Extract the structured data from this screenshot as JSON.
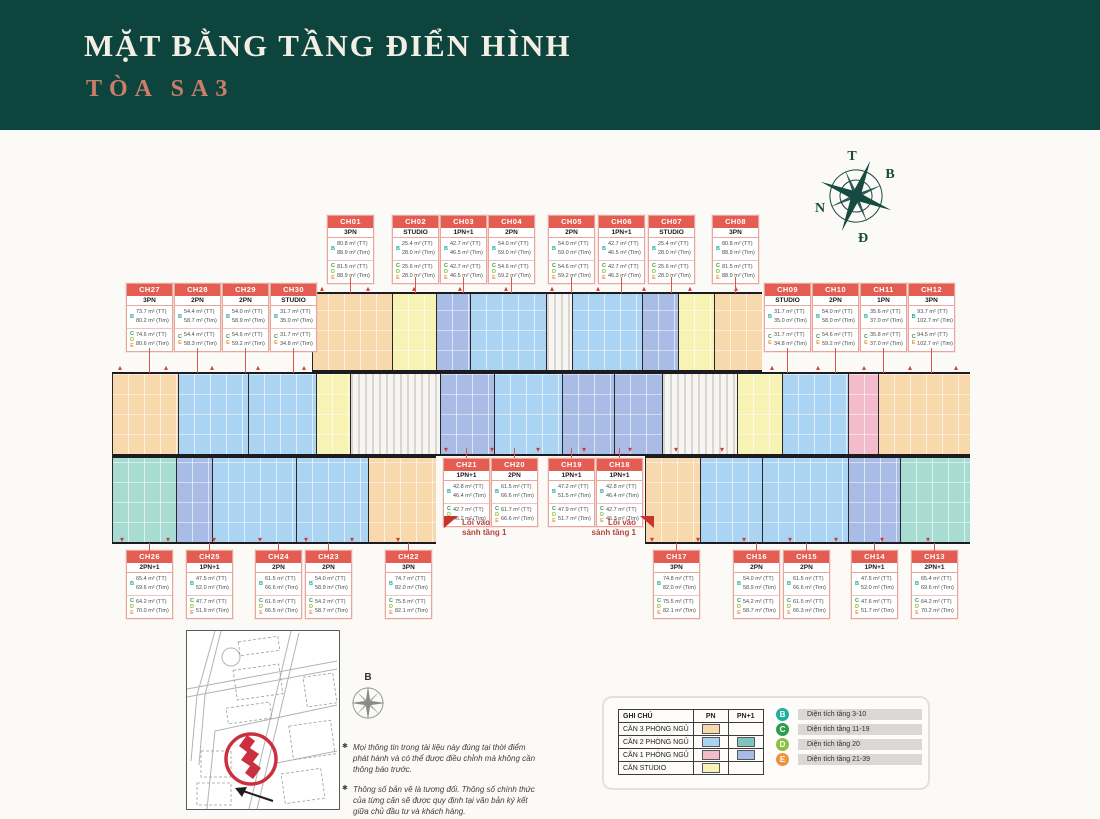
{
  "header": {
    "title": "MẶT BẰNG TẦNG ĐIỂN HÌNH",
    "subtitle": "TÒA SA3",
    "bg_color": "#0d453e",
    "subtitle_color": "#cb7e69"
  },
  "compass": {
    "t": "T",
    "b": "B",
    "n": "N",
    "d": "Đ"
  },
  "labels": {
    "tt": "(TT)",
    "tim": "(Tim)",
    "entrance_line1": "Lối vào",
    "entrance_line2": "sảnh tầng 1"
  },
  "type_colors": {
    "3PN": "#f7d9ad",
    "2PN": "#aad4f2",
    "2PN+1": "#a8dcd3",
    "1PN": "#f3bccd",
    "1PN+1": "#a9bce5",
    "STUDIO": "#f7f3b5",
    "core": "#f6f5f1"
  },
  "units": [
    {
      "id": "CH01",
      "type": "3PN",
      "row": "top",
      "pos": [
        327,
        215
      ],
      "rows": [
        {
          "f": "B",
          "tt": "80.8 m²",
          "tim": "88.9 m²"
        },
        {
          "f": "CDE",
          "tt": "81.5 m²",
          "tim": "88.9 m²"
        }
      ]
    },
    {
      "id": "CH02",
      "type": "STUDIO",
      "row": "top",
      "pos": [
        392,
        215
      ],
      "rows": [
        {
          "f": "B",
          "tt": "25.4 m²",
          "tim": "28.0 m²"
        },
        {
          "f": "CDE",
          "tt": "25.6 m²",
          "tim": "28.0 m²"
        }
      ]
    },
    {
      "id": "CH03",
      "type": "1PN+1",
      "row": "top",
      "pos": [
        440,
        215
      ],
      "rows": [
        {
          "f": "B",
          "tt": "42.7 m²",
          "tim": "46.5 m²"
        },
        {
          "f": "CDE",
          "tt": "42.7 m²",
          "tim": "46.5 m²"
        }
      ]
    },
    {
      "id": "CH04",
      "type": "2PN",
      "row": "top",
      "pos": [
        488,
        215
      ],
      "rows": [
        {
          "f": "B",
          "tt": "54.0 m²",
          "tim": "59.0 m²"
        },
        {
          "f": "CDE",
          "tt": "54.6 m²",
          "tim": "59.2 m²"
        }
      ]
    },
    {
      "id": "CH05",
      "type": "2PN",
      "row": "top",
      "pos": [
        548,
        215
      ],
      "rows": [
        {
          "f": "B",
          "tt": "54.0 m²",
          "tim": "59.0 m²"
        },
        {
          "f": "CDE",
          "tt": "54.6 m²",
          "tim": "59.2 m²"
        }
      ]
    },
    {
      "id": "CH06",
      "type": "1PN+1",
      "row": "top",
      "pos": [
        598,
        215
      ],
      "rows": [
        {
          "f": "B",
          "tt": "42.7 m²",
          "tim": "46.5 m²"
        },
        {
          "f": "CDE",
          "tt": "42.7 m²",
          "tim": "46.3 m²"
        }
      ]
    },
    {
      "id": "CH07",
      "type": "STUDIO",
      "row": "top",
      "pos": [
        648,
        215
      ],
      "rows": [
        {
          "f": "B",
          "tt": "25.4 m²",
          "tim": "28.0 m²"
        },
        {
          "f": "CDE",
          "tt": "25.6 m²",
          "tim": "28.0 m²"
        }
      ]
    },
    {
      "id": "CH08",
      "type": "3PN",
      "row": "top",
      "pos": [
        712,
        215
      ],
      "rows": [
        {
          "f": "B",
          "tt": "80.8 m²",
          "tim": "88.9 m²"
        },
        {
          "f": "CDE",
          "tt": "81.5 m²",
          "tim": "88.9 m²"
        }
      ]
    },
    {
      "id": "CH09",
      "type": "STUDIO",
      "row": "right",
      "pos": [
        764,
        283
      ],
      "rows": [
        {
          "f": "B",
          "tt": "31.7 m²",
          "tim": "35.0 m²"
        },
        {
          "f": "CE",
          "tt": "31.7 m²",
          "tim": "34.8 m²"
        }
      ]
    },
    {
      "id": "CH10",
      "type": "2PN",
      "row": "right",
      "pos": [
        812,
        283
      ],
      "rows": [
        {
          "f": "B",
          "tt": "54.0 m²",
          "tim": "58.0 m²"
        },
        {
          "f": "CE",
          "tt": "54.6 m²",
          "tim": "59.2 m²"
        }
      ]
    },
    {
      "id": "CH11",
      "type": "1PN",
      "row": "right",
      "pos": [
        860,
        283
      ],
      "rows": [
        {
          "f": "B",
          "tt": "35.6 m²",
          "tim": "37.0 m²"
        },
        {
          "f": "CE",
          "tt": "35.8 m²",
          "tim": "37.0 m²"
        }
      ]
    },
    {
      "id": "CH12",
      "type": "3PN",
      "row": "right",
      "pos": [
        908,
        283
      ],
      "rows": [
        {
          "f": "B",
          "tt": "93.7 m²",
          "tim": "102.7 m²"
        },
        {
          "f": "CE",
          "tt": "94.5 m²",
          "tim": "102.7 m²"
        }
      ]
    },
    {
      "id": "CH13",
      "type": "2PN+1",
      "row": "br",
      "pos": [
        911,
        550
      ],
      "rows": [
        {
          "f": "B",
          "tt": "65.4 m²",
          "tim": "69.6 m²"
        },
        {
          "f": "CDE",
          "tt": "64.2 m²",
          "tim": "70.2 m²"
        }
      ]
    },
    {
      "id": "CH14",
      "type": "1PN+1",
      "row": "br",
      "pos": [
        851,
        550
      ],
      "rows": [
        {
          "f": "B",
          "tt": "47.5 m²",
          "tim": "52.0 m²"
        },
        {
          "f": "CDE",
          "tt": "47.6 m²",
          "tim": "51.7 m²"
        }
      ]
    },
    {
      "id": "CH15",
      "type": "2PN",
      "row": "br",
      "pos": [
        783,
        550
      ],
      "rows": [
        {
          "f": "B",
          "tt": "61.5 m²",
          "tim": "66.6 m²"
        },
        {
          "f": "CDE",
          "tt": "61.5 m²",
          "tim": "66.3 m²"
        }
      ]
    },
    {
      "id": "CH16",
      "type": "2PN",
      "row": "br",
      "pos": [
        733,
        550
      ],
      "rows": [
        {
          "f": "B",
          "tt": "54.0 m²",
          "tim": "58.9 m²"
        },
        {
          "f": "CDE",
          "tt": "54.2 m²",
          "tim": "58.7 m²"
        }
      ]
    },
    {
      "id": "CH17",
      "type": "3PN",
      "row": "br",
      "pos": [
        653,
        550
      ],
      "rows": [
        {
          "f": "B",
          "tt": "74.8 m²",
          "tim": "82.0 m²"
        },
        {
          "f": "CDE",
          "tt": "75.5 m²",
          "tim": "82.1 m²"
        }
      ]
    },
    {
      "id": "CH18",
      "type": "1PN+1",
      "row": "mid",
      "pos": [
        596,
        458
      ],
      "rows": [
        {
          "f": "B",
          "tt": "42.8 m²",
          "tim": "46.4 m²"
        },
        {
          "f": "CDE",
          "tt": "42.7 m²",
          "tim": "46.3 m²"
        }
      ]
    },
    {
      "id": "CH19",
      "type": "1PN+1",
      "row": "mid",
      "pos": [
        548,
        458
      ],
      "rows": [
        {
          "f": "B",
          "tt": "47.2 m²",
          "tim": "51.5 m²"
        },
        {
          "f": "CDE",
          "tt": "47.9 m²",
          "tim": "51.7 m²"
        }
      ]
    },
    {
      "id": "CH20",
      "type": "2PN",
      "row": "mid",
      "pos": [
        491,
        458
      ],
      "rows": [
        {
          "f": "B",
          "tt": "61.5 m²",
          "tim": "66.6 m²"
        },
        {
          "f": "CDE",
          "tt": "61.7 m²",
          "tim": "66.6 m²"
        }
      ]
    },
    {
      "id": "CH21",
      "type": "1PN+1",
      "row": "mid",
      "pos": [
        443,
        458
      ],
      "rows": [
        {
          "f": "B",
          "tt": "42.8 m²",
          "tim": "46.4 m²"
        },
        {
          "f": "CDE",
          "tt": "42.7 m²",
          "tim": "46.2 m²"
        }
      ]
    },
    {
      "id": "CH22",
      "type": "3PN",
      "row": "bl",
      "pos": [
        385,
        550
      ],
      "rows": [
        {
          "f": "B",
          "tt": "74.7 m²",
          "tim": "82.0 m²"
        },
        {
          "f": "CDE",
          "tt": "75.5 m²",
          "tim": "82.1 m²"
        }
      ]
    },
    {
      "id": "CH23",
      "type": "2PN",
      "row": "bl",
      "pos": [
        305,
        550
      ],
      "rows": [
        {
          "f": "B",
          "tt": "54.0 m²",
          "tim": "58.9 m²"
        },
        {
          "f": "CDE",
          "tt": "54.2 m²",
          "tim": "58.7 m²"
        }
      ]
    },
    {
      "id": "CH24",
      "type": "2PN",
      "row": "bl",
      "pos": [
        255,
        550
      ],
      "rows": [
        {
          "f": "B",
          "tt": "61.5 m²",
          "tim": "66.6 m²"
        },
        {
          "f": "CDE",
          "tt": "61.5 m²",
          "tim": "66.5 m²"
        }
      ]
    },
    {
      "id": "CH25",
      "type": "1PN+1",
      "row": "bl",
      "pos": [
        186,
        550
      ],
      "rows": [
        {
          "f": "B",
          "tt": "47.5 m²",
          "tim": "52.0 m²"
        },
        {
          "f": "CDE",
          "tt": "47.7 m²",
          "tim": "51.9 m²"
        }
      ]
    },
    {
      "id": "CH26",
      "type": "2PN+1",
      "row": "bl",
      "pos": [
        126,
        550
      ],
      "rows": [
        {
          "f": "B",
          "tt": "65.4 m²",
          "tim": "69.6 m²"
        },
        {
          "f": "CDE",
          "tt": "64.2 m²",
          "tim": "70.0 m²"
        }
      ]
    },
    {
      "id": "CH27",
      "type": "3PN",
      "row": "left",
      "pos": [
        126,
        283
      ],
      "rows": [
        {
          "f": "B",
          "tt": "73.7 m²",
          "tim": "80.2 m²"
        },
        {
          "f": "CDE",
          "tt": "74.6 m²",
          "tim": "80.6 m²"
        }
      ]
    },
    {
      "id": "CH28",
      "type": "2PN",
      "row": "left",
      "pos": [
        174,
        283
      ],
      "rows": [
        {
          "f": "B",
          "tt": "54.4 m²",
          "tim": "58.7 m²"
        },
        {
          "f": "CE",
          "tt": "54.4 m²",
          "tim": "58.3 m²"
        }
      ]
    },
    {
      "id": "CH29",
      "type": "2PN",
      "row": "left",
      "pos": [
        222,
        283
      ],
      "rows": [
        {
          "f": "B",
          "tt": "54.0 m²",
          "tim": "58.9 m²"
        },
        {
          "f": "CE",
          "tt": "54.6 m²",
          "tim": "59.2 m²"
        }
      ]
    },
    {
      "id": "CH30",
      "type": "STUDIO",
      "row": "left",
      "pos": [
        270,
        283
      ],
      "rows": [
        {
          "f": "B",
          "tt": "31.7 m²",
          "tim": "35.0 m²"
        },
        {
          "f": "CE",
          "tt": "31.7 m²",
          "tim": "34.8 m²"
        }
      ]
    }
  ],
  "plan": {
    "bands": [
      {
        "y": 292,
        "h": 80,
        "blocks": [
          {
            "id": "CH01",
            "t": "3PN",
            "x": 312,
            "w": 80
          },
          {
            "id": "CH02",
            "t": "STUDIO",
            "x": 392,
            "w": 44
          },
          {
            "id": "CH03",
            "t": "1PN+1",
            "x": 436,
            "w": 34
          },
          {
            "id": "CH04",
            "t": "2PN",
            "x": 470,
            "w": 76
          },
          {
            "id": "",
            "t": "core",
            "x": 546,
            "w": 26
          },
          {
            "id": "CH05",
            "t": "2PN",
            "x": 572,
            "w": 70
          },
          {
            "id": "CH06",
            "t": "1PN+1",
            "x": 642,
            "w": 36
          },
          {
            "id": "CH07",
            "t": "STUDIO",
            "x": 678,
            "w": 36
          },
          {
            "id": "CH08",
            "t": "3PN",
            "x": 714,
            "w": 48
          }
        ]
      },
      {
        "y": 372,
        "h": 84,
        "blocks": [
          {
            "id": "CH27",
            "t": "3PN",
            "x": 112,
            "w": 66
          },
          {
            "id": "CH28",
            "t": "2PN",
            "x": 178,
            "w": 70
          },
          {
            "id": "CH29",
            "t": "2PN",
            "x": 248,
            "w": 68
          },
          {
            "id": "CH30",
            "t": "STUDIO",
            "x": 316,
            "w": 34
          },
          {
            "id": "",
            "t": "core",
            "x": 350,
            "w": 90
          },
          {
            "id": "CH21",
            "t": "1PN+1",
            "x": 440,
            "w": 54
          },
          {
            "id": "CH20",
            "t": "2PN",
            "x": 494,
            "w": 68
          },
          {
            "id": "CH19",
            "t": "1PN+1",
            "x": 562,
            "w": 52
          },
          {
            "id": "CH18",
            "t": "1PN+1",
            "x": 614,
            "w": 48
          },
          {
            "id": "",
            "t": "core",
            "x": 662,
            "w": 75
          },
          {
            "id": "CH09",
            "t": "STUDIO",
            "x": 737,
            "w": 45
          },
          {
            "id": "CH10",
            "t": "2PN",
            "x": 782,
            "w": 66
          },
          {
            "id": "CH11",
            "t": "1PN",
            "x": 848,
            "w": 30
          },
          {
            "id": "CH12",
            "t": "3PN",
            "x": 878,
            "w": 92
          }
        ]
      },
      {
        "y": 456,
        "h": 88,
        "blocks": [
          {
            "id": "CH26",
            "t": "2PN+1",
            "x": 112,
            "w": 64
          },
          {
            "id": "CH25",
            "t": "1PN+1",
            "x": 176,
            "w": 36
          },
          {
            "id": "CH24",
            "t": "2PN",
            "x": 212,
            "w": 84
          },
          {
            "id": "CH23",
            "t": "2PN",
            "x": 296,
            "w": 72
          },
          {
            "id": "CH22",
            "t": "3PN",
            "x": 368,
            "w": 68
          }
        ]
      },
      {
        "y": 456,
        "h": 88,
        "blocks": [
          {
            "id": "CH17",
            "t": "3PN",
            "x": 645,
            "w": 55
          },
          {
            "id": "CH16",
            "t": "2PN",
            "x": 700,
            "w": 62
          },
          {
            "id": "CH15",
            "t": "2PN",
            "x": 762,
            "w": 86
          },
          {
            "id": "CH14",
            "t": "1PN+1",
            "x": 848,
            "w": 52
          },
          {
            "id": "CH13",
            "t": "2PN+1",
            "x": 900,
            "w": 70
          }
        ]
      }
    ]
  },
  "legend": {
    "table": {
      "title": "GHI CHÚ",
      "col_pn": "PN",
      "col_pn1": "PN+1",
      "rows": [
        {
          "label": "CĂN 3 PHÒNG NGỦ",
          "pn": "#f7d9ad",
          "pn1": null
        },
        {
          "label": "CĂN 2 PHÒNG NGỦ",
          "pn": "#aad4f2",
          "pn1": "#7fc4bd"
        },
        {
          "label": "CĂN 1 PHÒNG NGỦ",
          "pn": "#f3bccd",
          "pn1": "#a9bce5"
        },
        {
          "label": "CĂN STUDIO",
          "pn": "#f7f3b5",
          "pn1": null
        }
      ]
    },
    "floors": [
      {
        "letter": "B",
        "color": "#1fae9f",
        "label": "Diện tích tầng 3-10"
      },
      {
        "letter": "C",
        "color": "#2d9e4f",
        "label": "Diện tích tầng 11-19"
      },
      {
        "letter": "D",
        "color": "#8cc043",
        "label": "Diện tích tầng 20"
      },
      {
        "letter": "E",
        "color": "#ef9240",
        "label": "Diện tích tầng 21-39"
      }
    ]
  },
  "sitemap": {
    "compass_label": "B"
  },
  "notes": [
    "Mọi thông tin trong tài liệu này đúng tại thời điểm phát hành và có thể được điều chỉnh mà không cần thông báo trước.",
    "Thông số bản vẽ là tương đối. Thông số chính thức của từng căn sẽ được quy định tại văn bản ký kết giữa chủ đầu tư và khách hàng."
  ]
}
